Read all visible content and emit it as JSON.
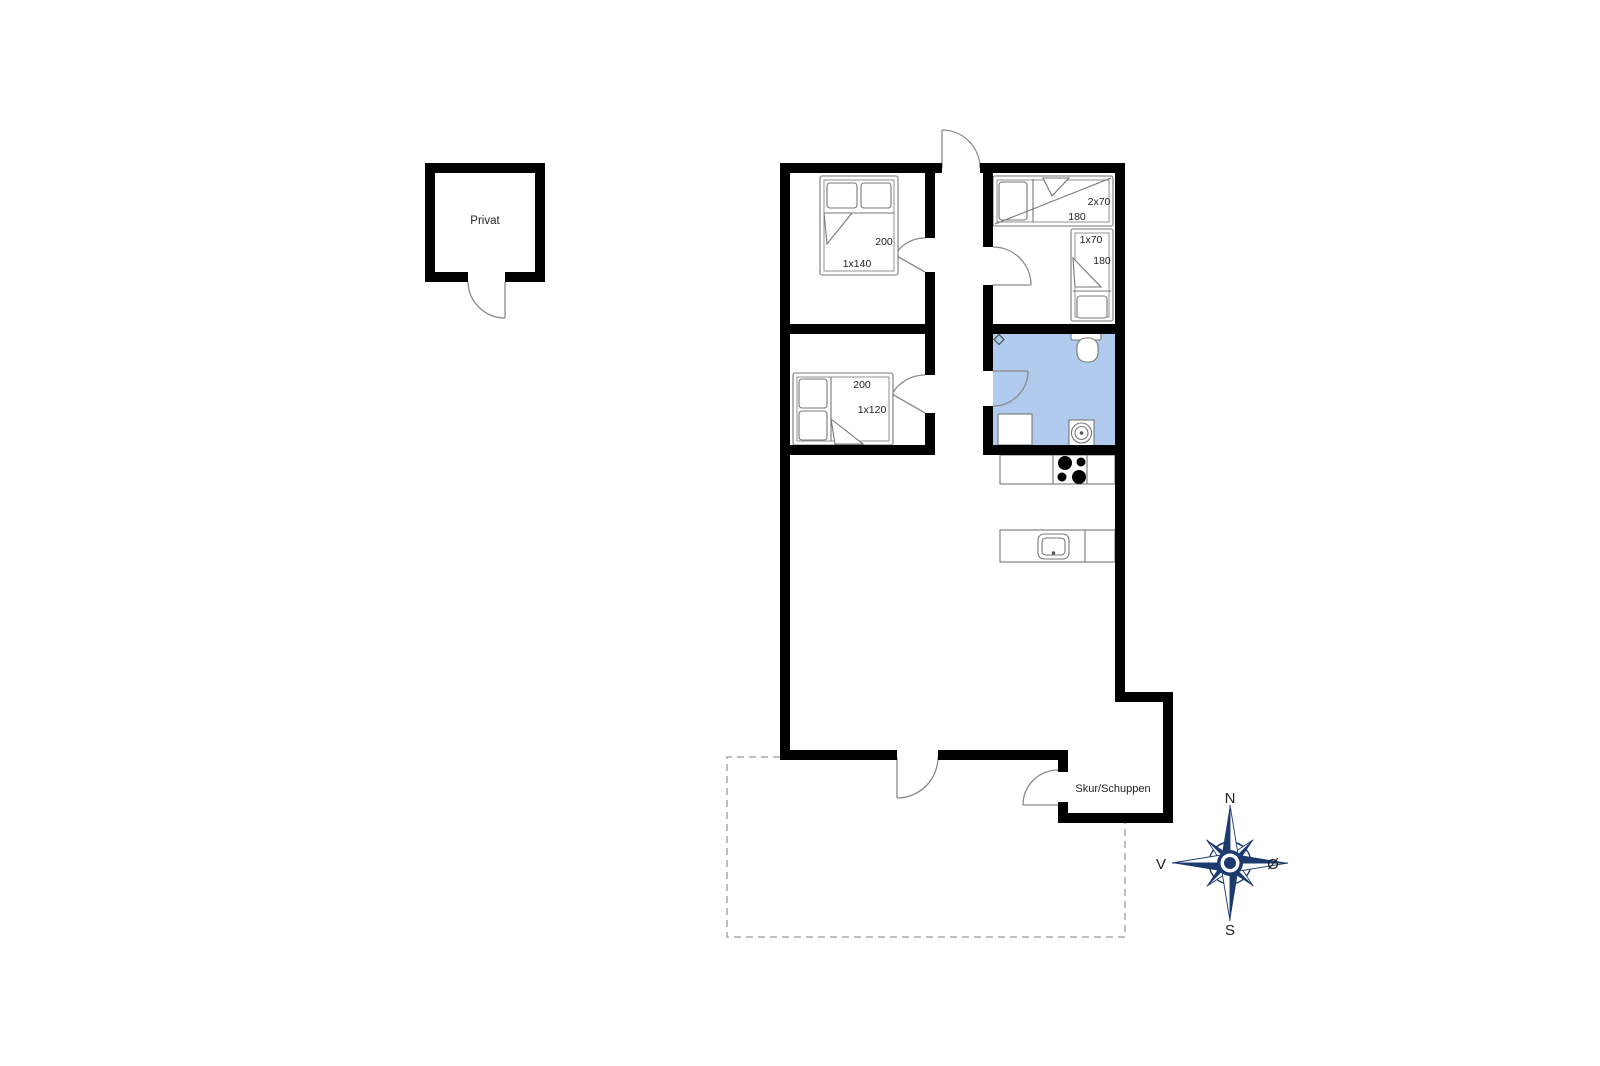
{
  "colors": {
    "wall": "#000000",
    "bathroom_fill": "#b0cbed",
    "compass_navy": "#1c3a6e",
    "door_line": "#8a8a8a",
    "furniture_line": "#777777",
    "dash_gray": "#9a9a9a"
  },
  "plan": {
    "outbuilding_label": "Privat",
    "shed_label": "Skur/Schuppen"
  },
  "rooms": {
    "bedroom1": {
      "bed_length": "200",
      "bed_size": "1x140"
    },
    "bedroom2": {
      "bunk_size": "2x70",
      "bunk_length": "180",
      "single_size": "1x70",
      "single_length": "180"
    },
    "bedroom3": {
      "bed_length": "200",
      "bed_size": "1x120"
    }
  },
  "compass": {
    "north": "N",
    "south": "S",
    "west": "V",
    "east": "Ø"
  }
}
